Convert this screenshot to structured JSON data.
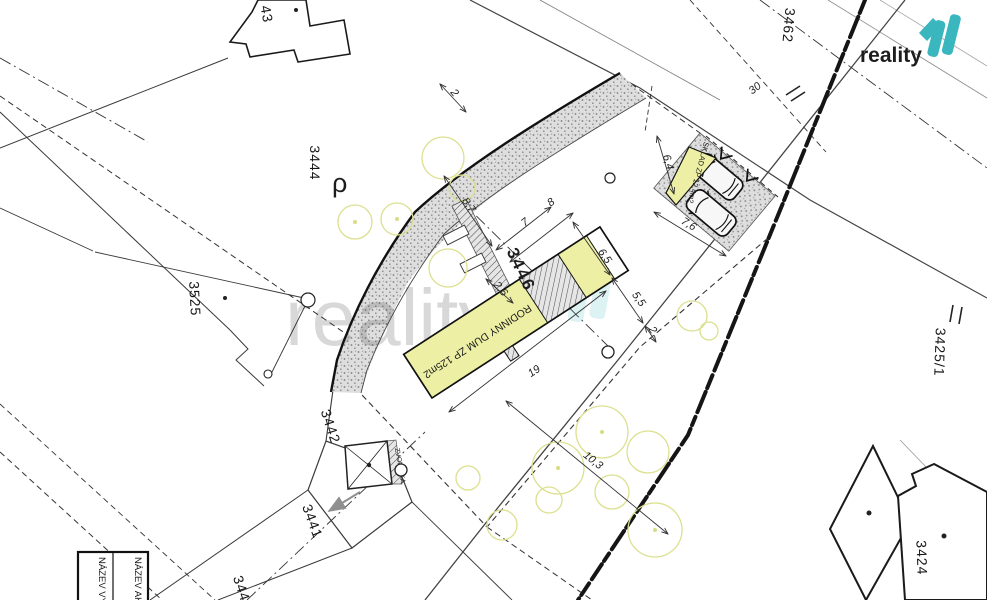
{
  "logo": {
    "text": "reality",
    "mark": "11",
    "text_color": "#474747",
    "mark_color": "#3ab6be"
  },
  "watermark": {
    "text": "reality",
    "mark": "11"
  },
  "parcels": [
    {
      "label": "43"
    },
    {
      "label": "3444"
    },
    {
      "label": "3462"
    },
    {
      "label": "3525"
    },
    {
      "label": "3446"
    },
    {
      "label": "3442"
    },
    {
      "label": "3441"
    },
    {
      "label": "344"
    },
    {
      "label": "3424"
    },
    {
      "label": "3425/1"
    }
  ],
  "buildings": {
    "house_label": "RODINNY DUM ZP 125m2",
    "storage_label": "SKLAD ZP 12,4m2",
    "bell_tower_label": "ZVONIČKA"
  },
  "dimensions": [
    {
      "value": "2"
    },
    {
      "value": "8,7"
    },
    {
      "value": "2,6"
    },
    {
      "value": "7"
    },
    {
      "value": "8"
    },
    {
      "value": "6,5"
    },
    {
      "value": "5,5"
    },
    {
      "value": "2"
    },
    {
      "value": "19"
    },
    {
      "value": "10,3"
    },
    {
      "value": "7,6"
    },
    {
      "value": "6,4"
    },
    {
      "value": "30"
    }
  ],
  "symbols": {
    "rho": "ρ"
  },
  "titleblock": {
    "left_column": "NÁZEV VÝ",
    "right_column": "NÁZEV AK"
  },
  "colors": {
    "highlight_yellow": "#edf0a4",
    "tree_green": "#dce08f",
    "logo_teal": "#3ab6be"
  }
}
